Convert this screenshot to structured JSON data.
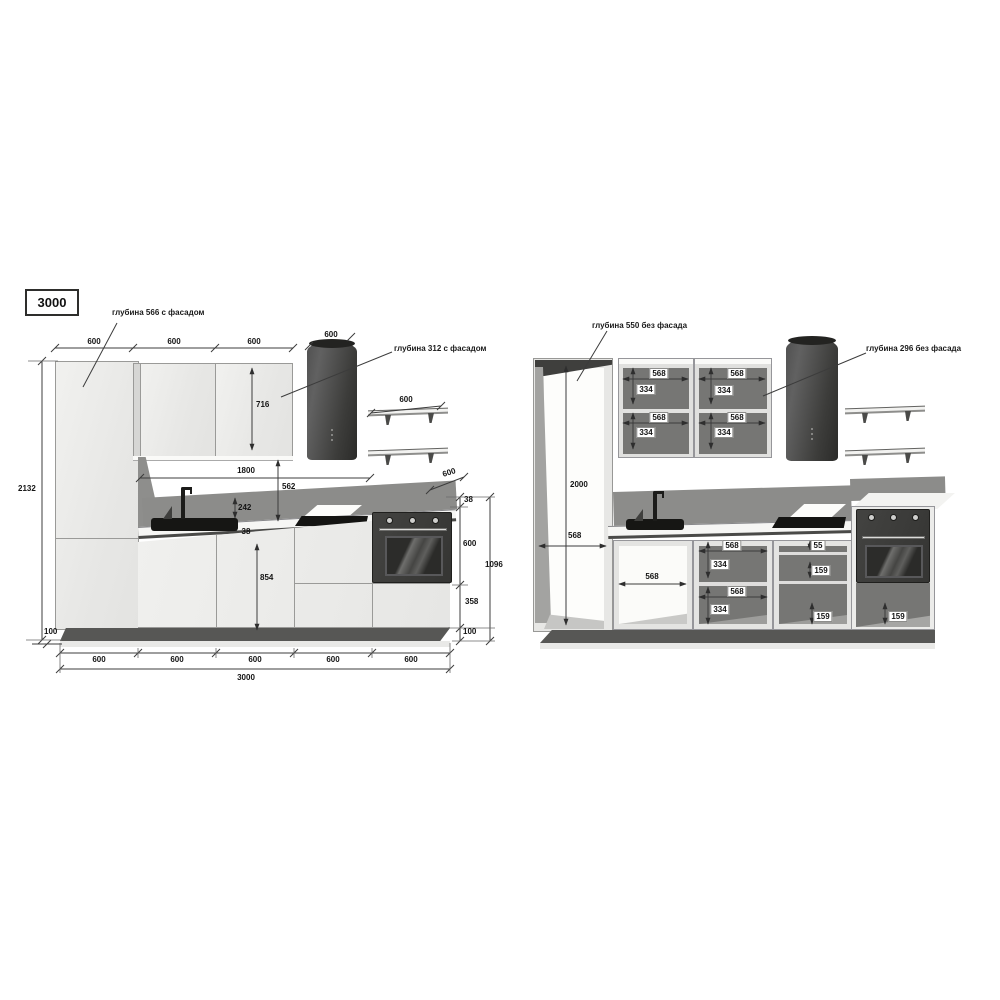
{
  "title": "3000",
  "left_view": {
    "callout_tall": "глубина 566 с фасадом",
    "callout_wall": "глубина 312 с фасадом",
    "top_widths": [
      "600",
      "600",
      "600"
    ],
    "hood_width": "600",
    "shelf_width": "600",
    "wall_cab_height": "716",
    "span_width": "1800",
    "splash_height": "562",
    "splash_gap": "242",
    "counter_thickness_mid": "38",
    "base_front_height": "854",
    "total_height": "2132",
    "plinth_left": "100",
    "counter_depth": "600",
    "counter_thickness_right": "38",
    "oven_height": "600",
    "lower_door_height": "358",
    "plinth_right": "100",
    "right_total": "1096",
    "bottom_widths": [
      "600",
      "600",
      "600",
      "600",
      "600"
    ],
    "total_width": "3000"
  },
  "right_view": {
    "callout_tall": "глубина 550 без фасада",
    "callout_wall": "глубина 296 без фасада",
    "tall_height": "2000",
    "tall_width": "568",
    "wall_sections": [
      {
        "w": "568",
        "h": "334"
      },
      {
        "w": "568",
        "h": "334"
      },
      {
        "w": "568",
        "h": "334"
      },
      {
        "w": "568",
        "h": "334"
      }
    ],
    "sink_width": "568",
    "base_sections": [
      {
        "w": "568",
        "h": "334"
      },
      {
        "w": "568",
        "h": "334"
      }
    ],
    "drawers": {
      "top": "55",
      "mid": "159",
      "bottom": "159",
      "oven": "159"
    }
  }
}
